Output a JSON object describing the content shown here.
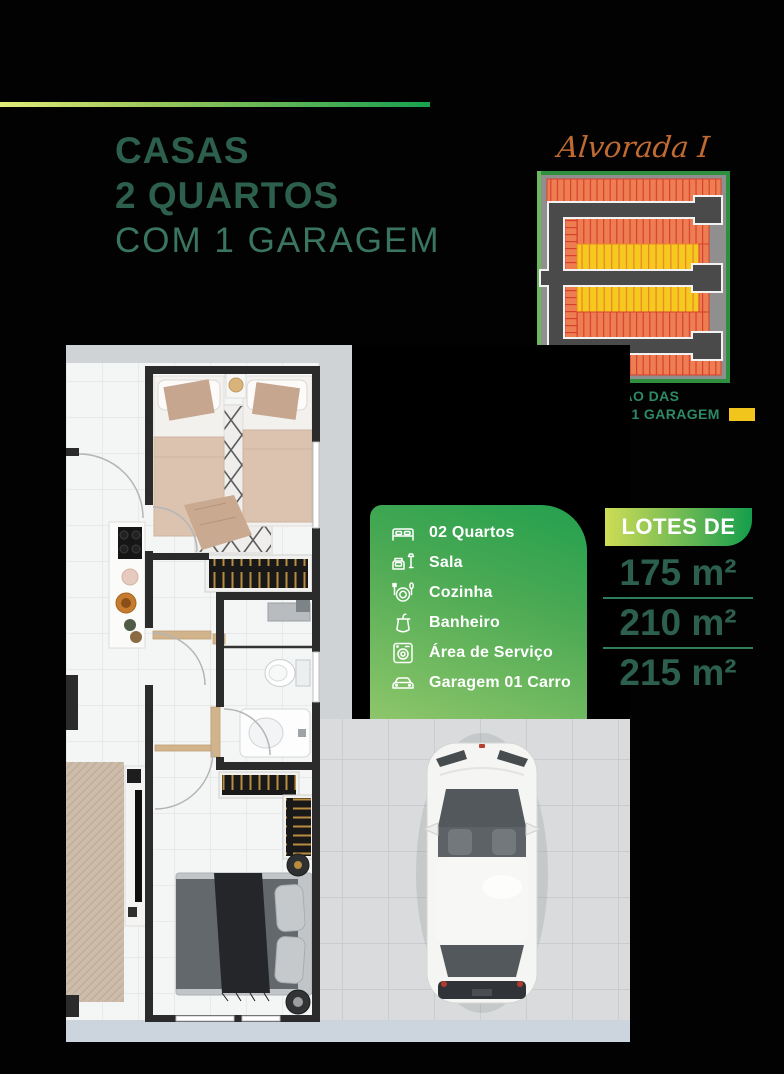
{
  "header": {
    "line1": "CASAS",
    "line2": "2 QUARTOS",
    "line3": "COM 1 GARAGEM",
    "title_color": "#2d5f4d",
    "accent_line_gradient": [
      "#e2ec78",
      "#18a04f"
    ]
  },
  "location": {
    "name": "Alvorada I",
    "name_color": "#c06a33",
    "caption_line1": "LOCALIZAÇÃO DAS",
    "caption_line2": "CASAS COM 1 GARAGEM",
    "caption_color": "#2e8a66",
    "legend_swatch_color": "#f2c51d",
    "map_colors": {
      "border": "#2e8f3f",
      "road": "#4a4a4a",
      "lot_orange": "#ee7e52",
      "lot_divider": "#d6402e",
      "lot_highlight_yellow": "#f6c91e"
    }
  },
  "features": {
    "panel_gradient": [
      "#23a04f",
      "#8ec66a"
    ],
    "items": [
      {
        "icon": "bed-icon",
        "label": "02 Quartos"
      },
      {
        "icon": "sofa-icon",
        "label": "Sala"
      },
      {
        "icon": "dining-icon",
        "label": "Cozinha"
      },
      {
        "icon": "shower-icon",
        "label": "Banheiro"
      },
      {
        "icon": "washer-icon",
        "label": "Área de Serviço"
      },
      {
        "icon": "car-icon",
        "label": "Garagem 01 Carro"
      }
    ]
  },
  "lots": {
    "badge_label": "LOTES DE",
    "badge_gradient": [
      "#cedd55",
      "#149e4b"
    ],
    "areas": [
      "175 m²",
      "210 m²",
      "215 m²"
    ],
    "areas_color": "#2c5f4e"
  }
}
